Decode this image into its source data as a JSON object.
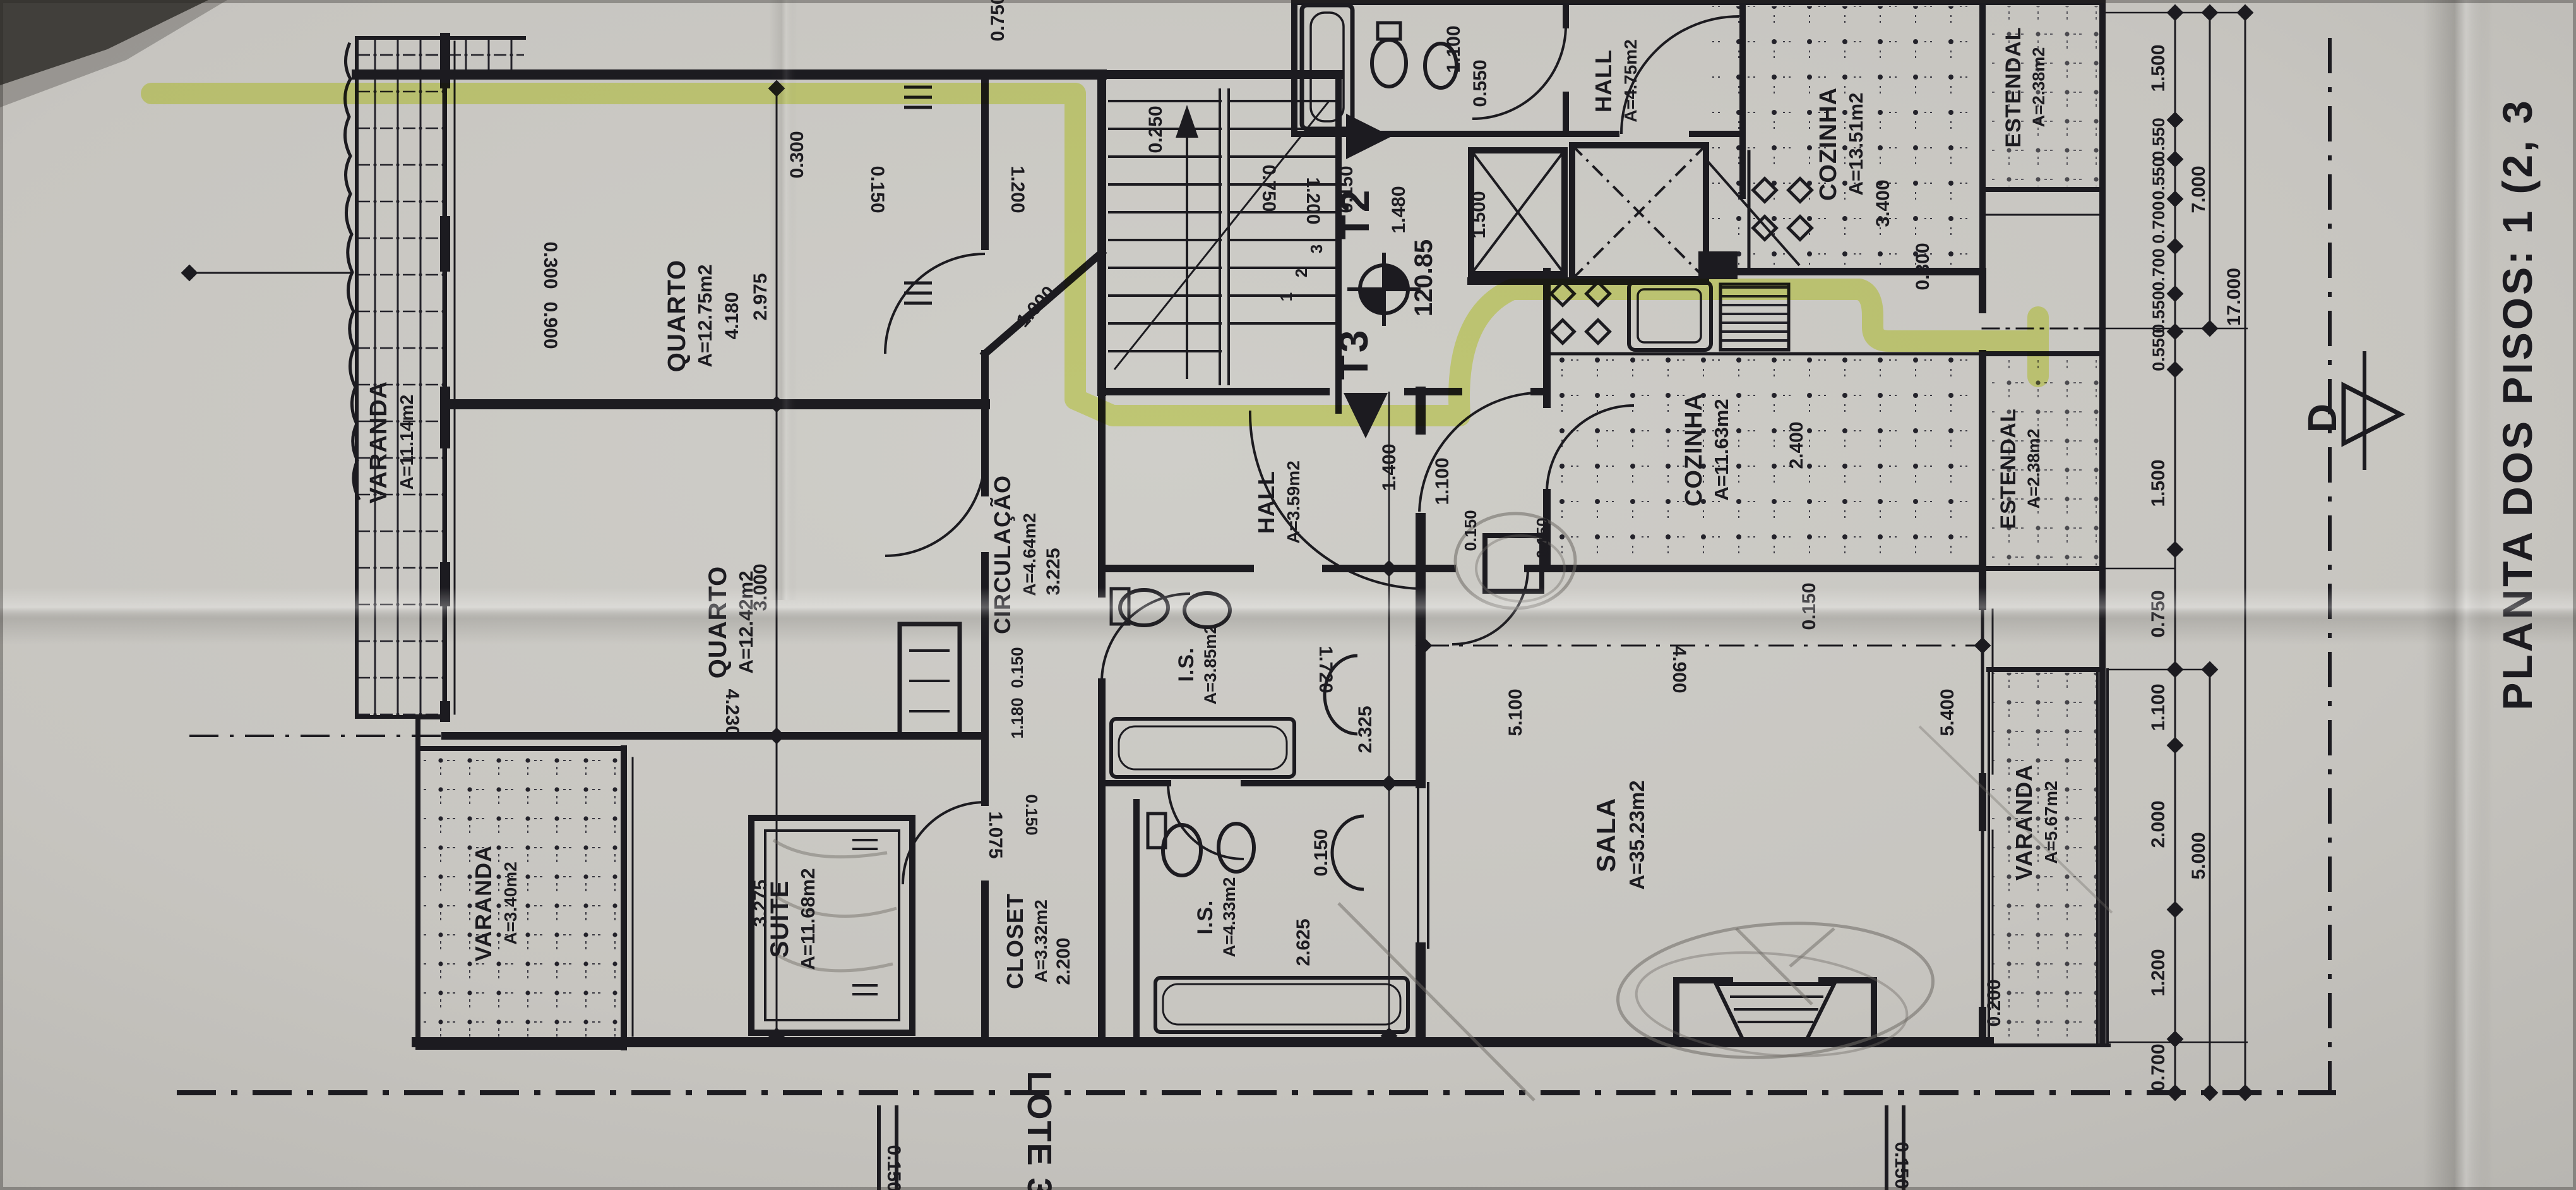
{
  "photo": {
    "title": "PLANTA DOS PISOS: 1 (2, 3",
    "lot_label": "LOTE 31",
    "section_marker": "D",
    "colors": {
      "paper": "#c9c7c2",
      "ink": "#1c1b20",
      "highlight": "#dfef4e",
      "pencil": "#6e6a64"
    }
  },
  "markers": {
    "t2": "T2",
    "t3": "T3",
    "level": "120.85",
    "stair_steps": [
      "1",
      "2",
      "3"
    ]
  },
  "rooms": [
    {
      "name": "VARANDA",
      "area": "A=11.14m2"
    },
    {
      "name": "QUARTO",
      "area": "A=12.75m2"
    },
    {
      "name": "QUARTO",
      "area": "A=12.42m2"
    },
    {
      "name": "SUITE",
      "area": "A=11.68m2"
    },
    {
      "name": "VARANDA",
      "area": "A=3.40m2"
    },
    {
      "name": "CLOSET",
      "area": "A=3.32m2"
    },
    {
      "name": "I.S.",
      "area": "A=4.33m2"
    },
    {
      "name": "I.S.",
      "area": "A=3.85m2"
    },
    {
      "name": "CIRCULAÇÃO",
      "area": "A=4.64m2"
    },
    {
      "name": "HALL",
      "area": "A=3.59m2"
    },
    {
      "name": "HALL",
      "area": "A=4.75m2"
    },
    {
      "name": "COZINHA",
      "area": "A=13.51m2"
    },
    {
      "name": "ESTENDAL",
      "area": "A=2.38m2"
    },
    {
      "name": "COZINHA",
      "area": "A=11.63m2"
    },
    {
      "name": "ESTENDAL",
      "area": "A=2.38m2"
    },
    {
      "name": "SALA",
      "area": "A=35.23m2"
    },
    {
      "name": "VARANDA",
      "area": "A=5.67m2"
    }
  ],
  "dims": [
    {
      "v": "0.300"
    },
    {
      "v": "0.150"
    },
    {
      "v": "4.180"
    },
    {
      "v": "2.975"
    },
    {
      "v": "3.000"
    },
    {
      "v": "3.275"
    },
    {
      "v": "4.230"
    },
    {
      "v": "0.300"
    },
    {
      "v": "0.900"
    },
    {
      "v": "1.000"
    },
    {
      "v": "0.250"
    },
    {
      "v": "1.200"
    },
    {
      "v": "0.750"
    },
    {
      "v": "1.200"
    },
    {
      "v": "0.150"
    },
    {
      "v": "1.100"
    },
    {
      "v": "0.550"
    },
    {
      "v": "0.750"
    },
    {
      "v": "1.480"
    },
    {
      "v": "1.500"
    },
    {
      "v": "3.400"
    },
    {
      "v": "0.300"
    },
    {
      "v": "2.400"
    },
    {
      "v": "0.150"
    },
    {
      "v": "4.900"
    },
    {
      "v": "1.400"
    },
    {
      "v": "1.100"
    },
    {
      "v": "0.150"
    },
    {
      "v": "0.150"
    },
    {
      "v": "1.720"
    },
    {
      "v": "2.325"
    },
    {
      "v": "0.150"
    },
    {
      "v": "2.625"
    },
    {
      "v": "5.100"
    },
    {
      "v": "5.400"
    },
    {
      "v": "0.200"
    },
    {
      "v": "3.225"
    },
    {
      "v": "0.150"
    },
    {
      "v": "1.180"
    },
    {
      "v": "1.075"
    },
    {
      "v": "0.150"
    },
    {
      "v": "2.200"
    },
    {
      "v": "1.500"
    },
    {
      "v": "0.550"
    },
    {
      "v": "0.550"
    },
    {
      "v": "0.700"
    },
    {
      "v": "0.700"
    },
    {
      "v": "0.550"
    },
    {
      "v": "0.550"
    },
    {
      "v": "1.500"
    },
    {
      "v": "0.750"
    },
    {
      "v": "1.100"
    },
    {
      "v": "2.000"
    },
    {
      "v": "1.200"
    },
    {
      "v": "0.700"
    },
    {
      "v": "7.000"
    },
    {
      "v": "5.000"
    },
    {
      "v": "17.000"
    },
    {
      "v": "0.150"
    },
    {
      "v": "0.150"
    }
  ]
}
